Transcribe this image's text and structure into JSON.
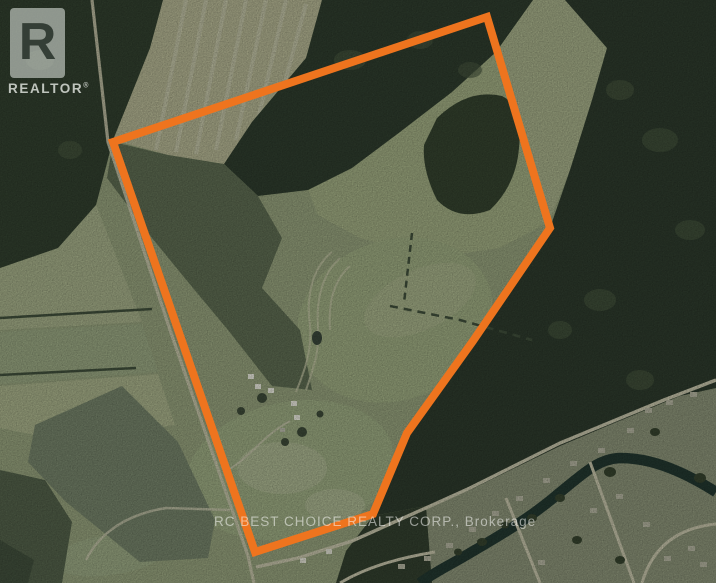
{
  "branding": {
    "realtor_logo": {
      "letter": "R",
      "label": "REALTOR",
      "registered_symbol": "®"
    },
    "brokerage_watermark": "RC BEST CHOICE REALTY CORP., Brokerage"
  },
  "map": {
    "boundary_color": "#EE741E",
    "watermark_color": "rgba(248,248,245,0.55)"
  }
}
